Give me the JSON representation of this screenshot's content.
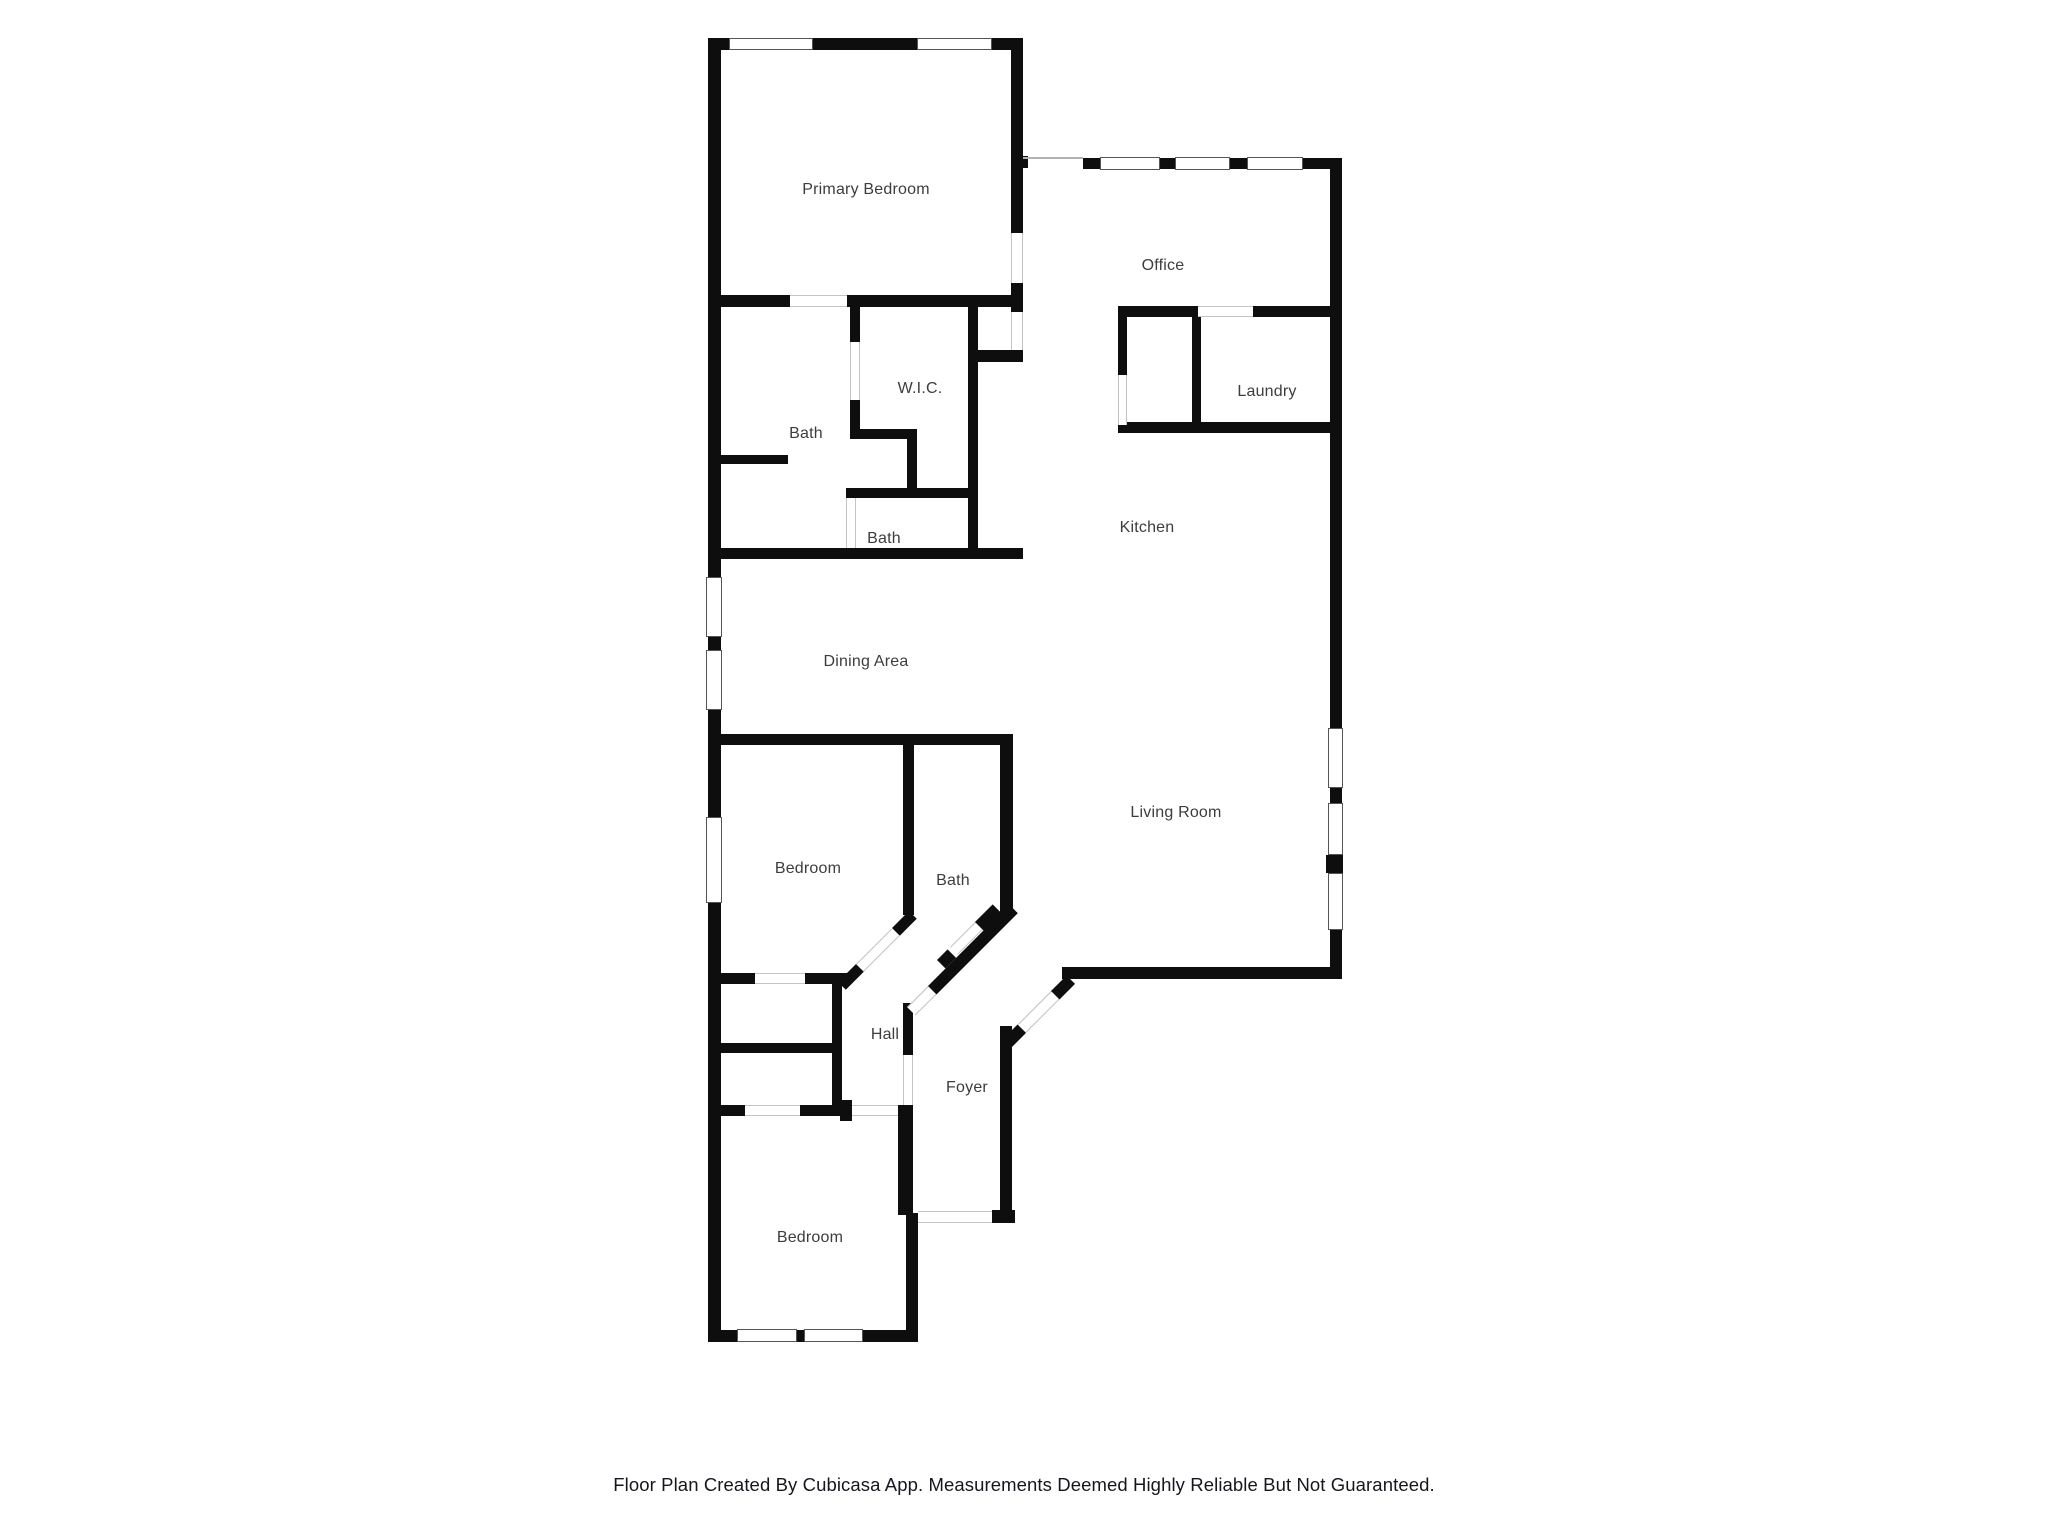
{
  "footer": {
    "text": "Floor Plan Created By Cubicasa App. Measurements Deemed Highly Reliable But Not Guaranteed."
  },
  "plan": {
    "wall_color": "#0e0e0e",
    "label_color": "#3d3d3d",
    "background_color": "#ffffff",
    "rooms": [
      {
        "id": "primary-bedroom",
        "label": "Primary Bedroom",
        "cx": 866,
        "cy": 190
      },
      {
        "id": "office",
        "label": "Office",
        "cx": 1163,
        "cy": 266
      },
      {
        "id": "wic",
        "label": "W.I.C.",
        "cx": 920,
        "cy": 389
      },
      {
        "id": "bath-primary",
        "label": "Bath",
        "cx": 806,
        "cy": 434
      },
      {
        "id": "laundry",
        "label": "Laundry",
        "cx": 1267,
        "cy": 392
      },
      {
        "id": "bath-second",
        "label": "Bath",
        "cx": 884,
        "cy": 539
      },
      {
        "id": "kitchen",
        "label": "Kitchen",
        "cx": 1147,
        "cy": 528
      },
      {
        "id": "dining-area",
        "label": "Dining Area",
        "cx": 866,
        "cy": 662
      },
      {
        "id": "bedroom-middle",
        "label": "Bedroom",
        "cx": 808,
        "cy": 869
      },
      {
        "id": "bath-hall",
        "label": "Bath",
        "cx": 953,
        "cy": 881
      },
      {
        "id": "living-room",
        "label": "Living Room",
        "cx": 1176,
        "cy": 813
      },
      {
        "id": "hall",
        "label": "Hall",
        "cx": 885,
        "cy": 1035
      },
      {
        "id": "foyer",
        "label": "Foyer",
        "cx": 967,
        "cy": 1088
      },
      {
        "id": "bedroom-bottom",
        "label": "Bedroom",
        "cx": 810,
        "cy": 1238
      }
    ],
    "walls": [
      [
        708,
        38,
        21,
        12
      ],
      [
        813,
        38,
        104,
        12
      ],
      [
        992,
        38,
        31,
        12
      ],
      [
        708,
        38,
        13,
        539
      ],
      [
        708,
        637,
        13,
        13
      ],
      [
        708,
        710,
        13,
        107
      ],
      [
        708,
        903,
        13,
        439
      ],
      [
        1011,
        38,
        12,
        195
      ],
      [
        1011,
        283,
        12,
        29
      ],
      [
        1011,
        156,
        17,
        12
      ],
      [
        968,
        350,
        55,
        12
      ],
      [
        968,
        295,
        10,
        264
      ],
      [
        708,
        295,
        82,
        12
      ],
      [
        847,
        295,
        166,
        12
      ],
      [
        850,
        295,
        10,
        47
      ],
      [
        850,
        400,
        10,
        38
      ],
      [
        850,
        429,
        65,
        10
      ],
      [
        907,
        429,
        10,
        67
      ],
      [
        846,
        488,
        132,
        10
      ],
      [
        708,
        455,
        80,
        9
      ],
      [
        708,
        548,
        315,
        11
      ],
      [
        718,
        734,
        295,
        11
      ],
      [
        903,
        745,
        11,
        170
      ],
      [
        1000,
        734,
        13,
        181
      ],
      [
        708,
        973,
        47,
        11
      ],
      [
        805,
        973,
        43,
        11
      ],
      [
        708,
        1043,
        134,
        10
      ],
      [
        832,
        983,
        10,
        122
      ],
      [
        708,
        1105,
        37,
        11
      ],
      [
        800,
        1105,
        40,
        11
      ],
      [
        840,
        1100,
        12,
        21
      ],
      [
        898,
        1105,
        15,
        110
      ],
      [
        906,
        1213,
        12,
        129
      ],
      [
        708,
        1330,
        29,
        12
      ],
      [
        797,
        1330,
        7,
        12
      ],
      [
        863,
        1330,
        55,
        12
      ],
      [
        903,
        1003,
        10,
        52
      ],
      [
        1000,
        1026,
        12,
        187
      ],
      [
        992,
        1210,
        23,
        13
      ],
      [
        1062,
        967,
        280,
        12
      ],
      [
        1330,
        158,
        12,
        570
      ],
      [
        1330,
        788,
        12,
        15
      ],
      [
        1326,
        855,
        17,
        18
      ],
      [
        1330,
        930,
        12,
        49
      ],
      [
        1083,
        158,
        17,
        11
      ],
      [
        1160,
        158,
        15,
        11
      ],
      [
        1230,
        158,
        17,
        11
      ],
      [
        1303,
        158,
        39,
        11
      ],
      [
        1118,
        306,
        80,
        11
      ],
      [
        1253,
        306,
        89,
        11
      ],
      [
        1118,
        306,
        9,
        69
      ],
      [
        1192,
        306,
        9,
        127
      ],
      [
        1118,
        422,
        224,
        11
      ]
    ],
    "windows": [
      [
        729,
        38,
        84,
        12
      ],
      [
        917,
        38,
        75,
        12
      ],
      [
        706,
        577,
        16,
        60
      ],
      [
        706,
        650,
        16,
        60
      ],
      [
        706,
        817,
        16,
        86
      ],
      [
        737,
        1329,
        60,
        13
      ],
      [
        804,
        1329,
        59,
        13
      ],
      [
        1100,
        157,
        60,
        13
      ],
      [
        1175,
        157,
        55,
        13
      ],
      [
        1247,
        157,
        56,
        13
      ],
      [
        1328,
        728,
        15,
        60
      ],
      [
        1328,
        803,
        15,
        52
      ],
      [
        1328,
        873,
        15,
        57
      ]
    ],
    "openings": [
      {
        "x": 1011,
        "y": 233,
        "w": 12,
        "h": 50,
        "dir": "v"
      },
      {
        "x": 1011,
        "y": 312,
        "w": 12,
        "h": 38,
        "dir": "v"
      },
      {
        "x": 790,
        "y": 295,
        "w": 57,
        "h": 12,
        "dir": "h"
      },
      {
        "x": 850,
        "y": 342,
        "w": 10,
        "h": 58,
        "dir": "v"
      },
      {
        "x": 846,
        "y": 498,
        "w": 10,
        "h": 50,
        "dir": "v"
      },
      {
        "x": 1198,
        "y": 306,
        "w": 55,
        "h": 11,
        "dir": "h"
      },
      {
        "x": 1118,
        "y": 375,
        "w": 9,
        "h": 50,
        "dir": "v"
      },
      {
        "x": 755,
        "y": 973,
        "w": 50,
        "h": 11,
        "dir": "h"
      },
      {
        "x": 745,
        "y": 1105,
        "w": 55,
        "h": 11,
        "dir": "h"
      },
      {
        "x": 852,
        "y": 1105,
        "w": 46,
        "h": 11,
        "dir": "h"
      },
      {
        "x": 903,
        "y": 1055,
        "w": 10,
        "h": 50,
        "dir": "v"
      },
      {
        "x": 918,
        "y": 1211,
        "w": 74,
        "h": 12,
        "dir": "h"
      }
    ],
    "diagonals": [
      {
        "x": 838,
        "y": 982,
        "th": 11,
        "segments": [
          {
            "type": "wall",
            "from": 0,
            "to": 26
          },
          {
            "type": "open",
            "from": 26,
            "to": 76
          },
          {
            "type": "wall",
            "from": 76,
            "to": 100
          }
        ]
      },
      {
        "x": 907,
        "y": 1007,
        "th": 12,
        "segments": [
          {
            "type": "open",
            "from": 0,
            "to": 30
          },
          {
            "type": "wall",
            "from": 30,
            "to": 145
          }
        ]
      },
      {
        "x": 937,
        "y": 960,
        "th": 12,
        "segments": [
          {
            "type": "wall",
            "from": 0,
            "to": 15
          }
        ]
      },
      {
        "x": 950,
        "y": 947,
        "th": 11,
        "segments": [
          {
            "type": "open",
            "from": 0,
            "to": 38
          }
        ]
      },
      {
        "x": 975,
        "y": 922,
        "th": 14,
        "segments": [
          {
            "type": "wall",
            "from": 0,
            "to": 25
          }
        ]
      },
      {
        "x": 1002,
        "y": 1040,
        "th": 12,
        "segments": [
          {
            "type": "wall",
            "from": 0,
            "to": 22
          },
          {
            "type": "open",
            "from": 22,
            "to": 70
          },
          {
            "type": "wall",
            "from": 70,
            "to": 92
          }
        ]
      }
    ],
    "thin_lines": [
      [
        1023,
        157,
        60,
        2
      ]
    ]
  }
}
